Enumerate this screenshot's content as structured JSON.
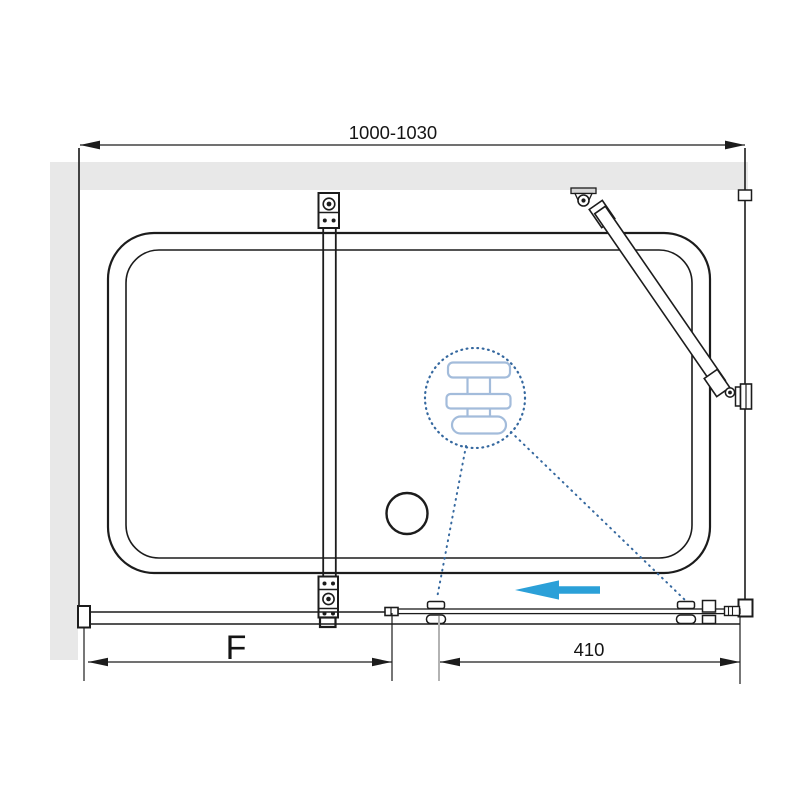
{
  "drawing": {
    "subject": "Sliding shower screen - technical installation drawing, front view",
    "dim_top": {
      "label": "1000-1030"
    },
    "dim_bottom_left": {
      "label": "F"
    },
    "dim_bottom_right": {
      "label": "410"
    },
    "colors": {
      "wall_fill": "#e8e8e8",
      "line": "#1c1c1c",
      "slide_arrow_blue": "#2ba0d8",
      "detail_dot_blue": "#35689f",
      "detail_light_blue": "#a3bcdb",
      "mount_plate_gray": "#d6d6d6",
      "extension_gray": "#b3b3b3"
    },
    "icons": {
      "slide_direction_arrow": "left-arrow",
      "roller_detail_callout": "dotted-circle-magnifier"
    }
  }
}
